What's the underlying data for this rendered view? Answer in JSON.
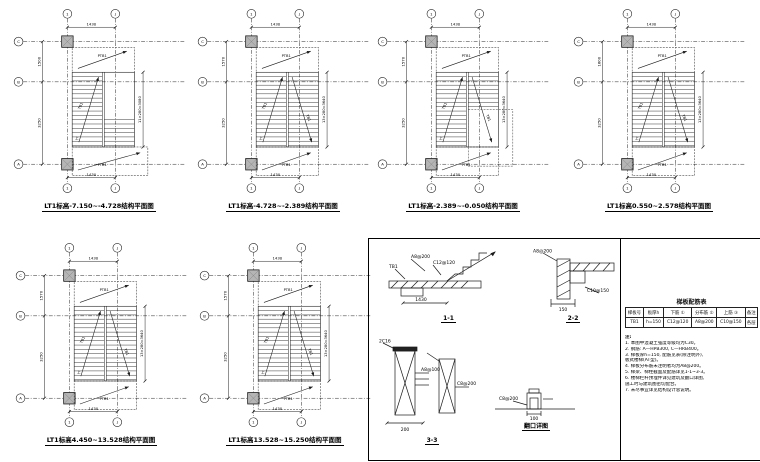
{
  "page": {
    "background": "#ffffff",
    "line_color": "#1a1a1a",
    "column_fill": "#b5b5b5"
  },
  "plans": [
    {
      "caption": "LT1标高-7.150~-4.728结构平面图",
      "variant": "A",
      "axis_top": [
        "1",
        "J"
      ],
      "axis_bottom": [
        "1",
        "J"
      ],
      "axis_left": [
        "C",
        "B",
        "A"
      ],
      "dims_top": "1430",
      "dims_bottom": "1430",
      "dims_left": [
        "1500",
        "3250"
      ],
      "dims_right": "11×280=3080"
    },
    {
      "caption": "LT1标高-4.728~-2.389结构平面图",
      "variant": "B",
      "axis_top": [
        "1",
        "J"
      ],
      "axis_bottom": [
        "1",
        "J"
      ],
      "axis_left": [
        "C",
        "B",
        "A"
      ],
      "dims_top": "1430",
      "dims_bottom": "1430",
      "dims_left": [
        "1570",
        "3250"
      ],
      "dims_right": "13×280=3640"
    },
    {
      "caption": "LT1标高-2.389~-0.050结构平面图",
      "variant": "C",
      "axis_top": [
        "1",
        "J"
      ],
      "axis_bottom": [
        "1",
        "J"
      ],
      "axis_left": [
        "C",
        "B",
        "A"
      ],
      "dims_top": "1430",
      "dims_bottom": "1430",
      "dims_left": [
        "1570",
        "3250"
      ],
      "dims_right": "13×280=3640"
    },
    {
      "caption": "LT1标高0.550~2.578结构平面图",
      "variant": "B",
      "axis_top": [
        "1",
        "J"
      ],
      "axis_bottom": [
        "1",
        "J"
      ],
      "axis_left": [
        "C",
        "B",
        "A"
      ],
      "dims_top": "1430",
      "dims_bottom": "1430",
      "dims_left": [
        "1600",
        "3250"
      ],
      "dims_right": "13×280=3640"
    },
    {
      "caption": "LT1标高4.450~13.528结构平面图",
      "variant": "B",
      "axis_top": [
        "1",
        "J"
      ],
      "axis_bottom": [
        "1",
        "J"
      ],
      "axis_left": [
        "C",
        "B",
        "A"
      ],
      "dims_top": "1430",
      "dims_bottom": "1430",
      "dims_left": [
        "1570",
        "3250"
      ],
      "dims_right": "13×280=3640"
    },
    {
      "caption": "LT1标高13.528~15.250结构平面图",
      "variant": "B",
      "axis_top": [
        "1",
        "J"
      ],
      "axis_bottom": [
        "1",
        "J"
      ],
      "axis_left": [
        "C",
        "B",
        "A"
      ],
      "dims_top": "1430",
      "dims_bottom": "1430",
      "dims_left": [
        "1570",
        "3250"
      ],
      "dims_right": "13×280=3640"
    }
  ],
  "marks": {
    "flight": "TB1",
    "landing": "PTB1",
    "up": "上"
  },
  "details": [
    {
      "caption": "1-1",
      "labels": [
        "A8@200",
        "C12@120",
        "TB1"
      ],
      "dim": "1430"
    },
    {
      "caption": "2-2",
      "labels": [
        "A8@200",
        "C10@150"
      ],
      "dim": "150"
    },
    {
      "caption": "3-3",
      "labels": [
        "2C16",
        "A8@100",
        "C8@200"
      ],
      "dim": "200"
    },
    {
      "caption": "翻口详图",
      "labels": [
        "C8@200"
      ],
      "dim": "100"
    }
  ],
  "schedule": {
    "title": "梯板配筋表",
    "headers": [
      "梯板号",
      "板厚h",
      "下筋 ①",
      "分布筋 ②",
      "上筋 ③",
      "备注"
    ],
    "rows": [
      [
        "TB1",
        "h=150",
        "C12@120",
        "A8@200",
        "C10@150",
        "各层"
      ]
    ]
  },
  "notes": {
    "heading": "注:",
    "lines": [
      "1. 本图中混凝土强度等级均为C30。",
      "2. 钢筋: A—HPB300, C—HRB400。",
      "3. 梯板厚h=150, 配筋见表(除注明外),",
      "    板式楼梯(AT型)。",
      "4. 梯板分布筋未注明者均为A8@200。",
      "5. 梯梁、梯柱截面及配筋详见1-1~3-3。",
      "6. 楼梯栏杆预埋件详见建筑及翻口详图,",
      "    施工时与建筑图密切配合。",
      "7. 未尽事宜详见结构设计总说明。"
    ]
  }
}
